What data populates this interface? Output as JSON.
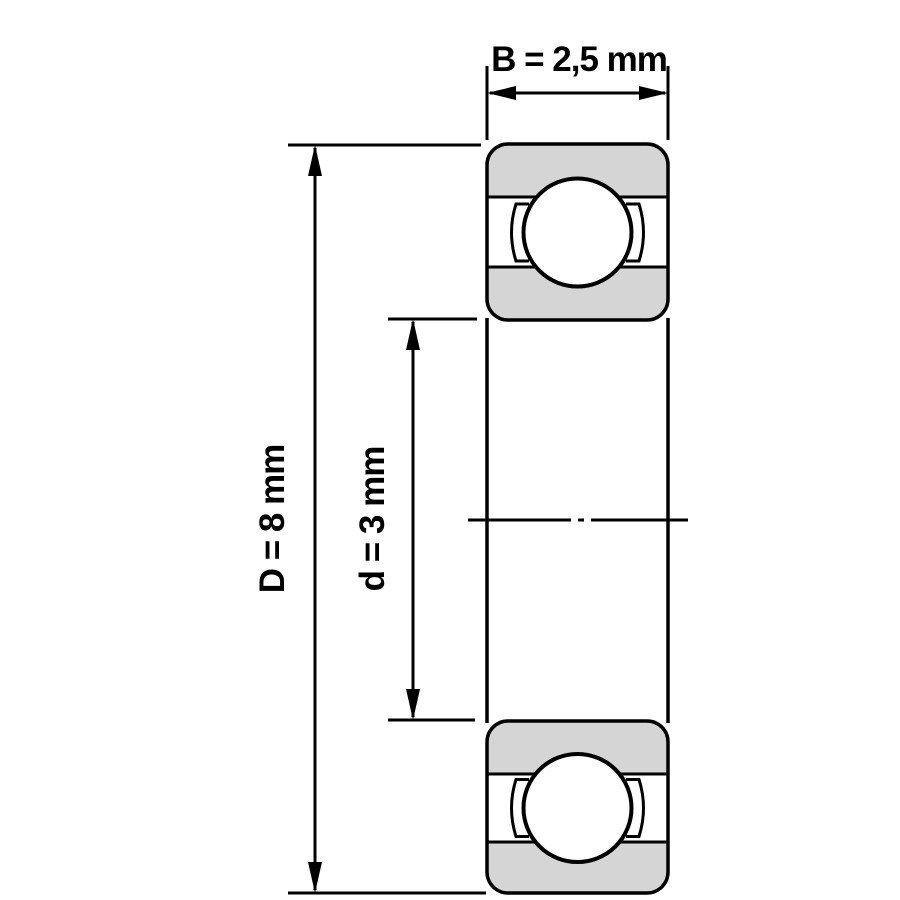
{
  "diagram": {
    "labels": {
      "width": "B = 2,5 mm",
      "outer_diameter": "D = 8 mm",
      "bore_diameter": "d = 3 mm"
    },
    "dimensions": [
      {
        "symbol": "B",
        "value": "2,5",
        "unit": "mm"
      },
      {
        "symbol": "D",
        "value": "8",
        "unit": "mm"
      },
      {
        "symbol": "d",
        "value": "3",
        "unit": "mm"
      }
    ],
    "colors": {
      "line": "#000000",
      "ring_fill": "#d5d5d5",
      "background": "#ffffff"
    }
  }
}
